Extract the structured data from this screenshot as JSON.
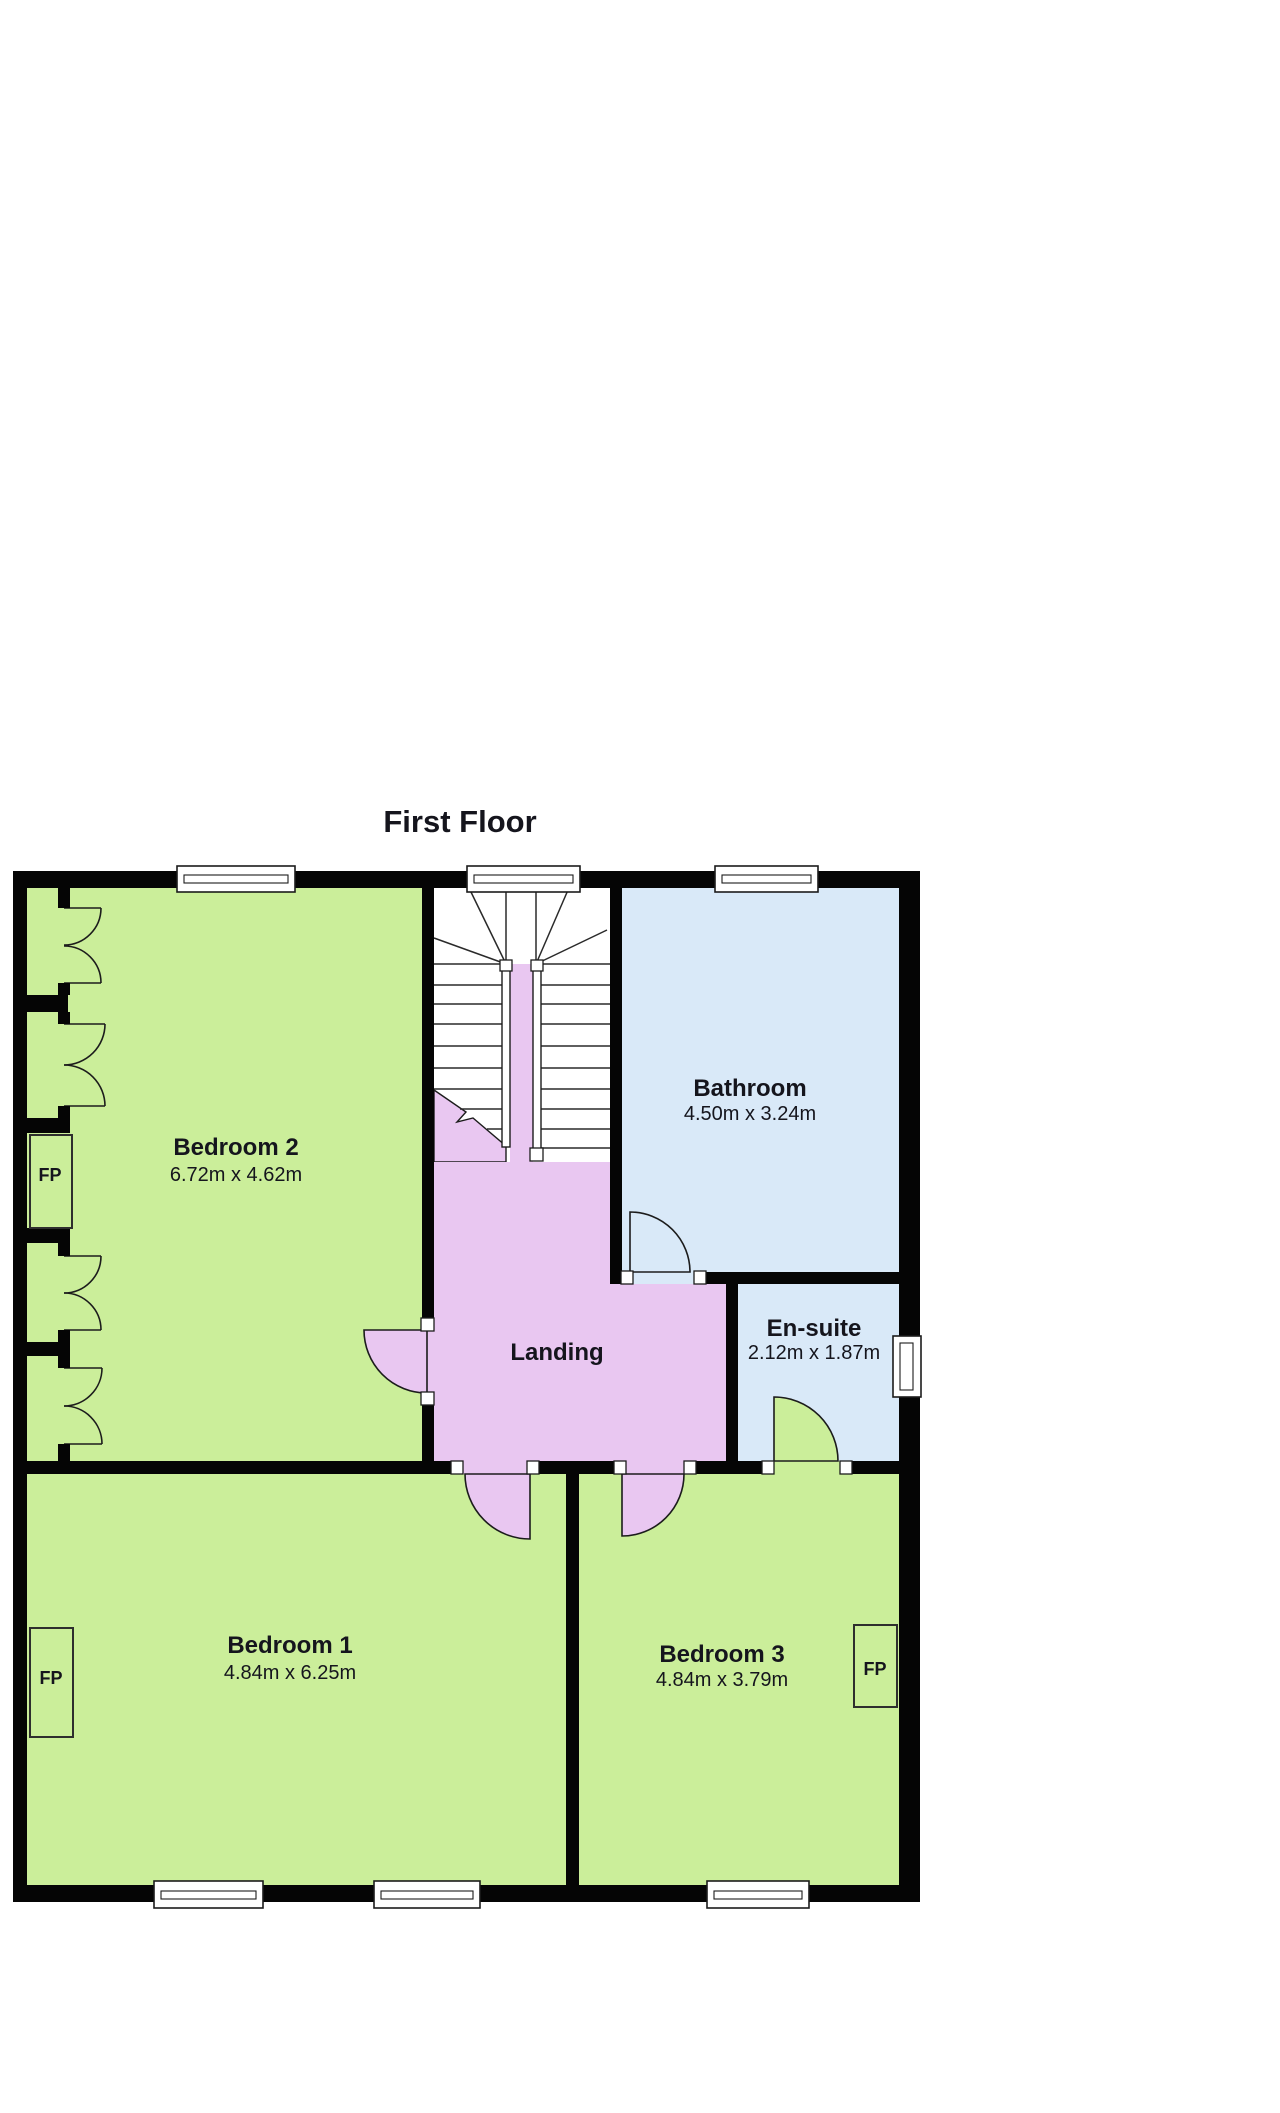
{
  "title": "First Floor",
  "palette": {
    "bedroom_green": "#cbee9a",
    "landing_purple": "#e9c7f1",
    "wet_room_blue": "#d9e9f8",
    "wall_black": "#050505",
    "background": "#ffffff"
  },
  "rooms": {
    "bedroom2": {
      "name": "Bedroom 2",
      "dims": "6.72m x 4.62m"
    },
    "bathroom": {
      "name": "Bathroom",
      "dims": "4.50m x 3.24m"
    },
    "landing": {
      "name": "Landing"
    },
    "ensuite": {
      "name": "En-suite",
      "dims": "2.12m x 1.87m"
    },
    "bedroom1": {
      "name": "Bedroom 1",
      "dims": "4.84m x 6.25m"
    },
    "bedroom3": {
      "name": "Bedroom 3",
      "dims": "4.84m x 3.79m"
    }
  },
  "fireplace": {
    "label": "FP"
  }
}
